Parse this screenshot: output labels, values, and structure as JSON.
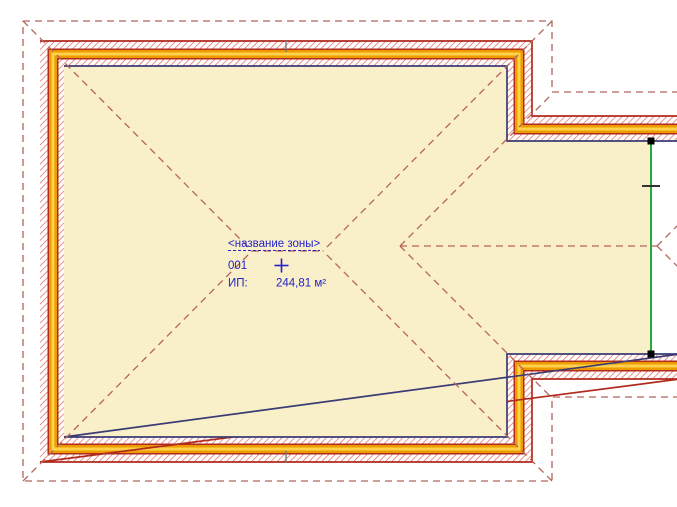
{
  "zone_stamp": {
    "name": "<название зоны>",
    "number": "001",
    "area_label": "ИП:",
    "area_value": "244,81 м²"
  },
  "colors": {
    "background": "#FFFFFF",
    "zone_fill": "#F9EFC9",
    "zone_border": "#3B3B75",
    "wall_outline": "#B02A1E",
    "wall_hatch": "#E4564A",
    "wall_band_orange": "#ED9C00",
    "wall_band_gold": "#FFD24D",
    "roof_dash": "#B4655A",
    "edge_line_green": "#0AA32E",
    "stamp_text_blue": "#2222CC",
    "handle_black": "#000000",
    "joint_tick_gray": "#777777"
  }
}
